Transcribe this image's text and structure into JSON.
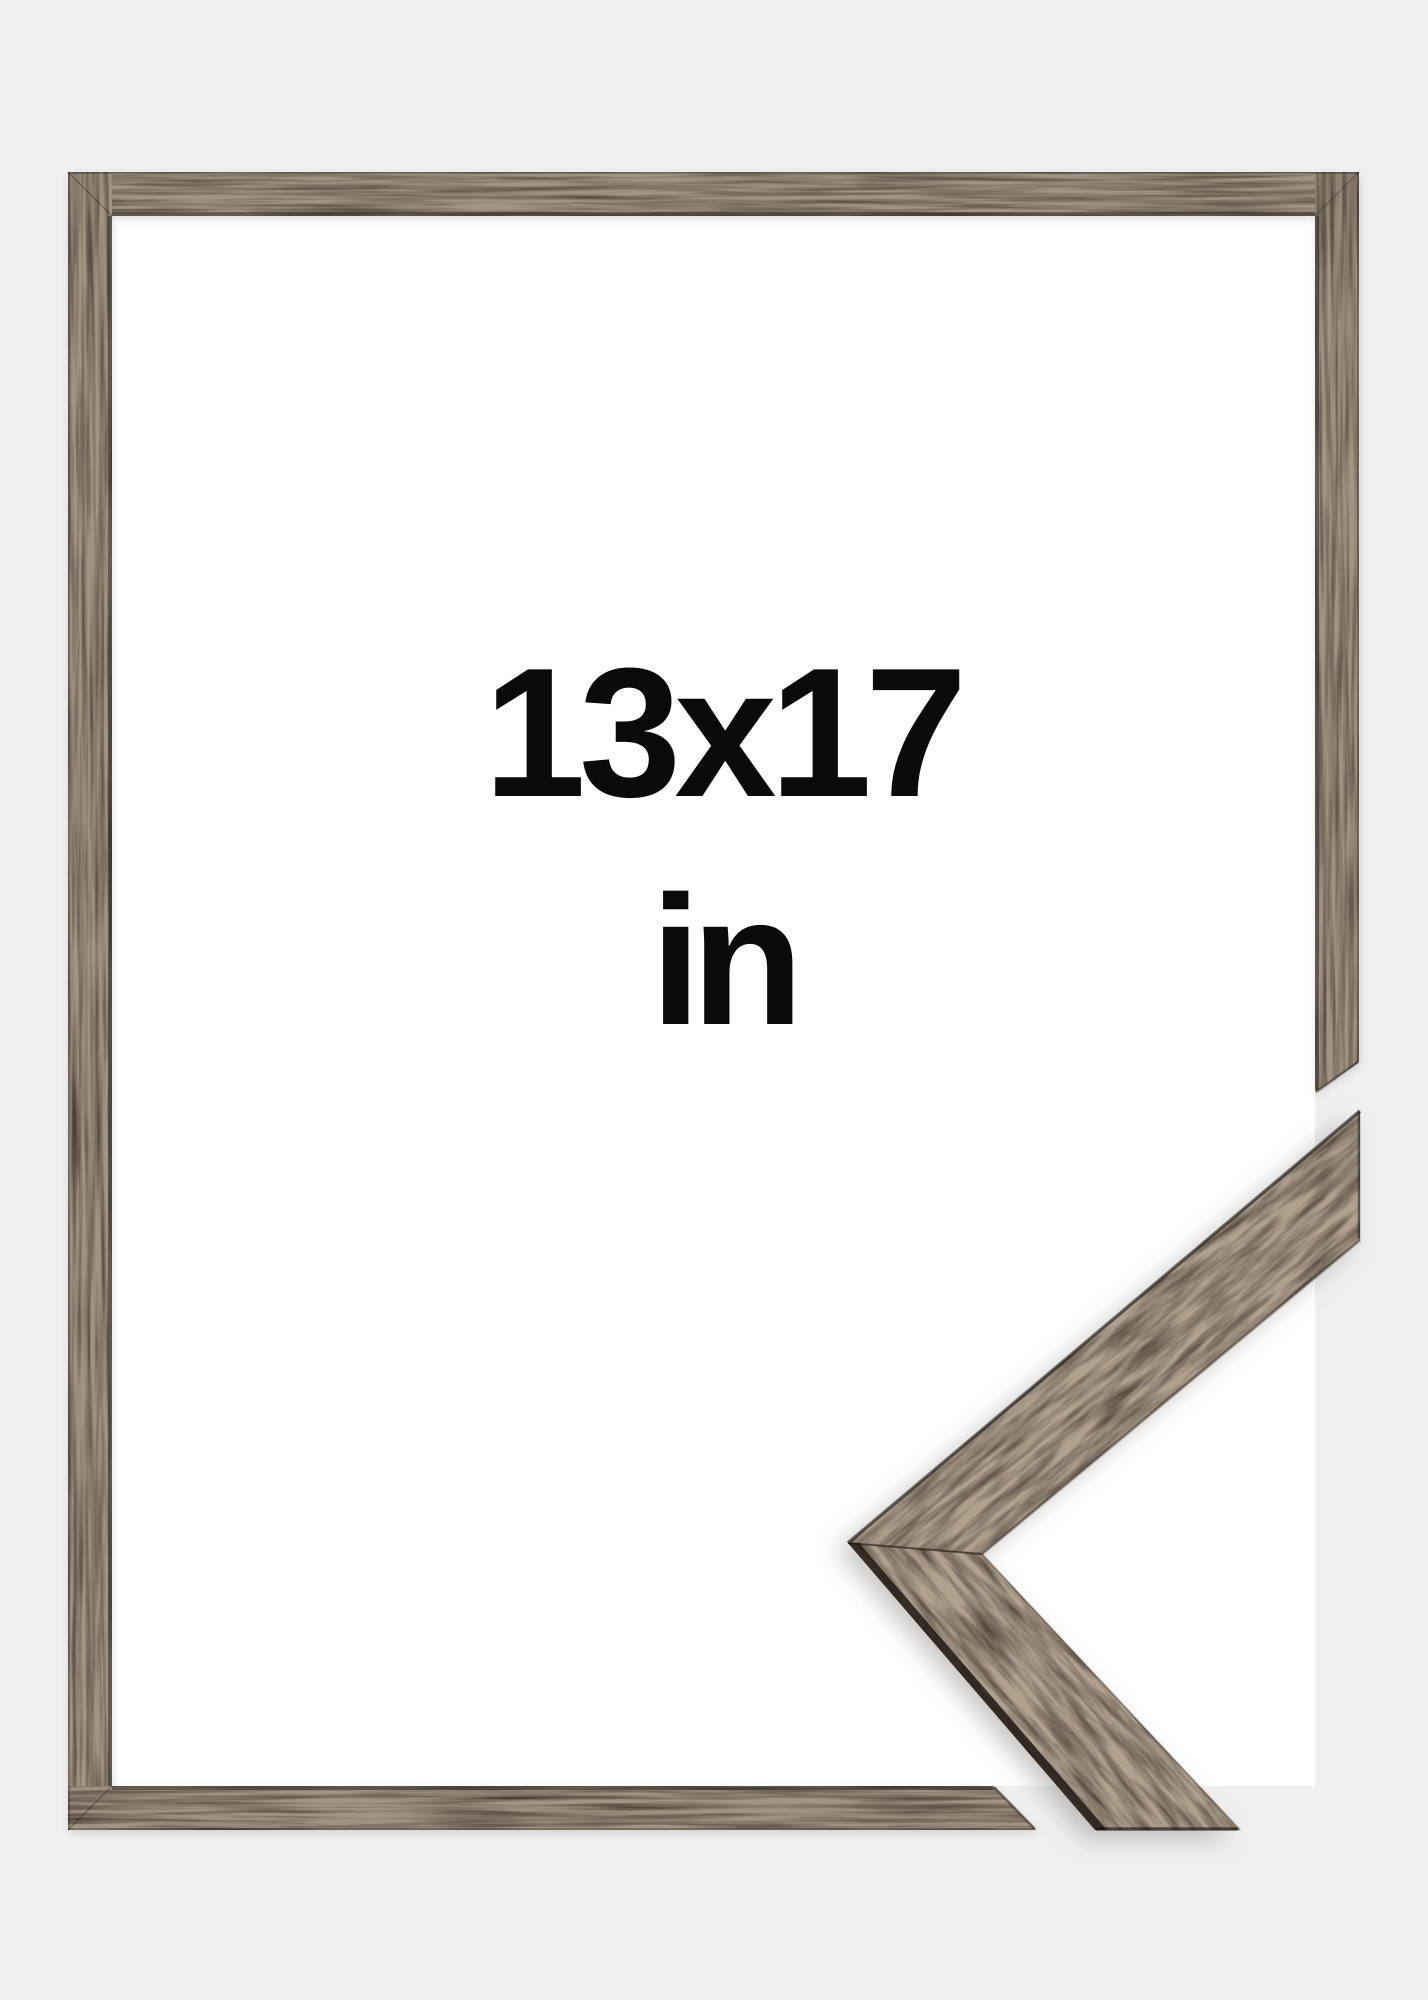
{
  "product_preview": {
    "size_label": "13x17",
    "unit_label": "in"
  },
  "colors": {
    "page_background": "#f0f0f1",
    "frame_opening_white": "#ffffff",
    "wood_bar_base": "#322920",
    "wood_face_base": "#2e251d",
    "wood_edge_dark": "#241d17",
    "seam_dark": "#1a140f",
    "text": "#0a0a0a"
  },
  "graphics": {
    "frame": "brown-wood-picture-frame",
    "corner_sample": "mitered-corner-profile-sample"
  }
}
